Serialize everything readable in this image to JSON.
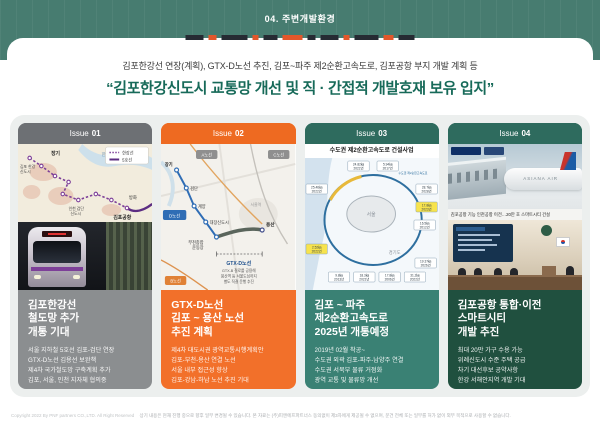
{
  "page": {
    "header_title": "04. 주변개발환경",
    "subtitle": "김포한강선 연장(계획), GTX-D노선 추진, 김포~파주 제2순환고속도로, 김포공항 부지 개발 계획 등",
    "main_title": "“김포한강신도시 교통망 개선 및 직 · 간접적 개발호재 보유 입지”",
    "copyright": "Copyright 2022 By PNF partners CO.,LTD. All Right Reserved",
    "disclaimer": "상기 내용은 현재 진행 중으로 향후 일부 변경될 수 있습니다. 본 자료는 (주)피앤에프파트너스 동의없이 제3자에게 제공될 수 없으며, 문건 전체 또는 일부를 허가 없이 외부 목적으로 사용할 수 없습니다."
  },
  "colors": {
    "band_teal": "#477c70",
    "title_teal": "#176a59",
    "card1_header": "#6d7074",
    "card1_body": "#8b8e90",
    "card2_accent": "#f2702a",
    "card3_header": "#2e6b5e",
    "card3_body": "#3a8174",
    "card4_body": "#20503f",
    "metro_purple": "#7d3f98",
    "gtx_blue": "#2f6db5",
    "ring_blue": "#2e6f9f",
    "highlight_yellow": "#f7e34d"
  },
  "cards": [
    {
      "issue_label": "Issue",
      "issue_no": "01",
      "title_lines": [
        "김포한강선",
        "철도망 추가",
        "개통 기대"
      ],
      "body": [
        "서울 지하철 5호선 김포-검단 연장",
        "GTX-D노선 김용선 보완책",
        "제4차 국가철도망 구축계획 추가",
        "김포, 서울, 인천 지자체 협의중"
      ],
      "map": {
        "legend": [
          "한강선",
          "5호선"
        ],
        "labels": {
          "jangi": "장기",
          "gimpo_hangang_1": "김포 한강",
          "gimpo_hangang_2": "신도시",
          "incheon_1": "인천 검단",
          "incheon_2": "신도시",
          "hangang": "한강",
          "banghwa": "방화",
          "gimpo_airport": "김포공항"
        }
      }
    },
    {
      "issue_label": "Issue",
      "issue_no": "02",
      "title_lines": [
        "GTX-D노선",
        "김포 ~ 용산 노선",
        "추진 계획"
      ],
      "body": [
        "제4차 대도시권 광역교통시행계획안",
        "김포-부천-용산 연결 노선",
        "서울 내부 접근성 향상",
        "김포-강남-하남 노선 추진 기대"
      ],
      "map": {
        "line_pills": {
          "a": "A노선",
          "b": "B노선",
          "c": "C노선",
          "d": "D노선"
        },
        "stations": {
          "jangi": "장기",
          "geomdan": "검단",
          "gyeyang": "계양",
          "daejang": "대장신도시",
          "bucheon_1": "부천종합",
          "bucheon_2": "운동장",
          "seoul_station": "서울역",
          "yongsan": "용산"
        },
        "note_title": "GTX-D노선",
        "note_lines": [
          "GTX-B 철로를 공용해",
          "용산역 등 서울도심까지",
          "별도 직결 운행 추진"
        ]
      }
    },
    {
      "issue_label": "Issue",
      "issue_no": "03",
      "title_lines": [
        "김포 ~ 파주",
        "제2순환고속도로",
        "2025년 개통예정"
      ],
      "body": [
        "2019년 02월 착공~",
        "수도권 외곽 김포-파주-남양주 연결",
        "수도권 서북부 물류 거점화",
        "광역 교통 및 물류망 개선"
      ],
      "map": {
        "title": "수도권 제2순환고속도로 건설사업",
        "ring_label": "수도권 제2순환고속도로",
        "seoul": "서울",
        "gyeonggi": "경기도",
        "segments": [
          {
            "km": "24.82㎞",
            "yr": "2022년"
          },
          {
            "km": "5.94㎞",
            "yr": "2017년"
          },
          {
            "km": "28.7㎞",
            "yr": "2028년"
          },
          {
            "km": "17.8㎞",
            "yr": "2023년"
          },
          {
            "km": "16.5㎞",
            "yr": "2012년"
          },
          {
            "km": "25.46㎞",
            "yr": "2022년"
          },
          {
            "km": "2.52㎞",
            "yr": "2022년"
          },
          {
            "km": "9.8㎞",
            "yr": "2013년"
          },
          {
            "km": "18.3㎞",
            "yr": "2021년"
          },
          {
            "km": "17.8㎞",
            "yr": "2006년"
          },
          {
            "km": "31.2㎞",
            "yr": "2022년"
          },
          {
            "km": "19.37㎞",
            "yr": "2026년"
          }
        ]
      }
    },
    {
      "issue_label": "Issue",
      "issue_no": "04",
      "title_lines": [
        "김포공항 통합·이전",
        "스마트시티",
        "개발 추진"
      ],
      "body": [
        "최대 20만 가구 수용 가능",
        "위례신도시 수준 주택 공급",
        "차기 대선후보 공약사항",
        "한강 서해안지역 개발 기대"
      ],
      "media": {
        "news_caption": "김포공항 기능 인천공항 이전…20만 호 스마트시티 건설",
        "plane_text": "ASIANA AIR"
      }
    }
  ]
}
